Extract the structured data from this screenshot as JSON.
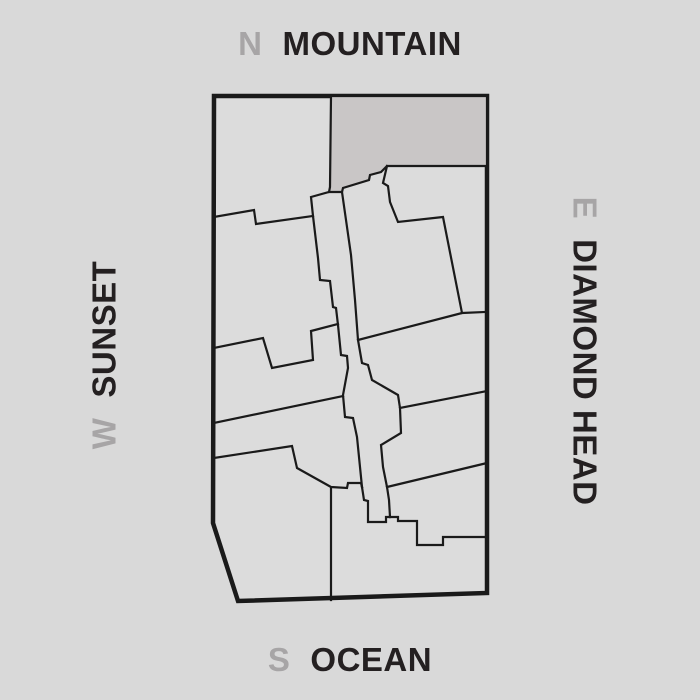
{
  "title": "Site orientation map",
  "compass": {
    "north": {
      "letter": "N",
      "name": "MOUNTAIN"
    },
    "south": {
      "letter": "S",
      "name": "OCEAN"
    },
    "west": {
      "letter": "W",
      "name": "SUNSET"
    },
    "east": {
      "letter": "E",
      "name": "DIAMOND HEAD"
    }
  },
  "colors": {
    "background": "#d9d9d9",
    "line": "#1a1a1a",
    "parcel_fill": "#dcdcdc",
    "highlight_fill": "#c9c6c6",
    "text_dark": "#242021",
    "text_gray": "#a7a5a6"
  },
  "map": {
    "outline": {
      "d": "M214,96 L487,96 L487,593 L238,601 L213,523 Z"
    },
    "highlight_parcel": {
      "d": "M331,96 L487,96 L487,166 L387,166 L381,172 L370,175 L369,180 L343,188 L342,192 L329,192 L330,187 Z"
    },
    "boundaries": [
      {
        "name": "corridor-left-edge",
        "d": "M329,192 L311,197 L313,216 L318,258 L320,280 L330,281 L333,307 L336,308 L338,325 L341,355 L347,356 L348,368 L343,395 L345,417 L353,418 L357,437 L360,467 L362,487"
      },
      {
        "name": "corridor-right-edge",
        "d": "M342,192 L346,220 L351,255 L355,300 L358,340 L362,363 L368,365 L372,380 L398,395 L400,408 L401,433 L381,445 L383,467 L387,487 L389,500 L390,517"
      },
      {
        "name": "west-strip-1-boundary",
        "d": "M214,217 L254,210 L256,224 L313,216"
      },
      {
        "name": "west-strip-2-boundary",
        "d": "M214,348 L263,338 L272,368 L313,360 L311,331 L338,324"
      },
      {
        "name": "west-strip-3-boundary",
        "d": "M214,423 L343,396"
      },
      {
        "name": "west-strip-4-boundary",
        "d": "M214,458 L292,446 L297,468 L331,487 L347,488 L348,483 L361,483 L362,487"
      },
      {
        "name": "south-parcel-divider",
        "d": "M331,488 L331,600"
      },
      {
        "name": "east-parcel-zigzag",
        "d": "M387,166 L383,183 L388,186 L390,202 L398,222 L443,217 L462,313"
      },
      {
        "name": "east-row-1-boundary",
        "d": "M358,340 L462,313 L485,312"
      },
      {
        "name": "east-row-2-boundary",
        "d": "M400,408 L487,391"
      },
      {
        "name": "east-row-3-boundary",
        "d": "M387,487 L487,463"
      },
      {
        "name": "corridor-foot",
        "d": "M362,487 L364,500 L368,501 L368,522 L386,522 L386,517 L390,517"
      },
      {
        "name": "southeast-step-boundary",
        "d": "M390,517 L398,517 L398,521 L417,521 L417,545 L443,545 L443,537 L487,537"
      }
    ]
  }
}
